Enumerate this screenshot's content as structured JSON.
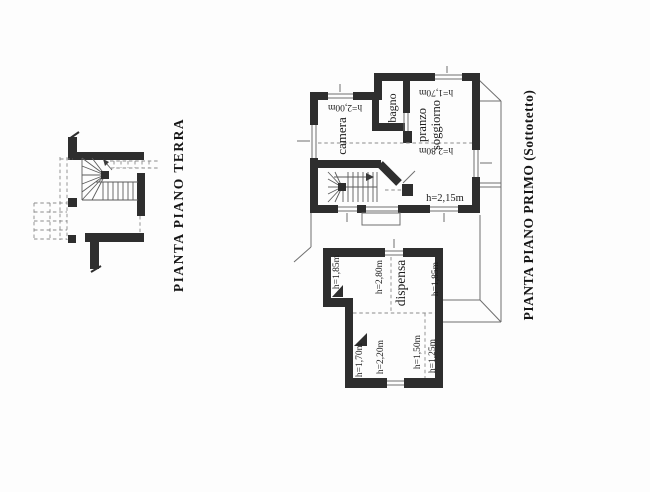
{
  "page": {
    "background": "#fdfdfd",
    "ink_color": "#2e2e2e",
    "thin_line_color": "#6f6f6f",
    "text_color": "#1b1b1b"
  },
  "ground_floor": {
    "title": "PIANTA PIANO TERRA"
  },
  "first_floor": {
    "title": "PIANTA PIANO PRIMO (Sottotetto)",
    "rooms": {
      "camera": {
        "name": "camera",
        "height": "h=2,00m"
      },
      "bagno": {
        "name": "bagno"
      },
      "pranzo": {
        "name_line1": "pranzo",
        "name_line2": "soggiorno",
        "height_eave": "h=1,70m",
        "height_ridge": "h=2,80m"
      },
      "hall": {
        "height": "h=2,15m"
      },
      "dispensa": {
        "name": "dispensa",
        "height_left_top": "h=1,85m",
        "height_mid_top": "h=2,80m",
        "height_right": "h=1,85m",
        "height_left_bottom": "h=1,70m",
        "height_mid_bottom": "h=2,20m",
        "height_right_bottom_1": "h=1,50m",
        "height_right_bottom_2": "h=1,25m"
      }
    }
  }
}
